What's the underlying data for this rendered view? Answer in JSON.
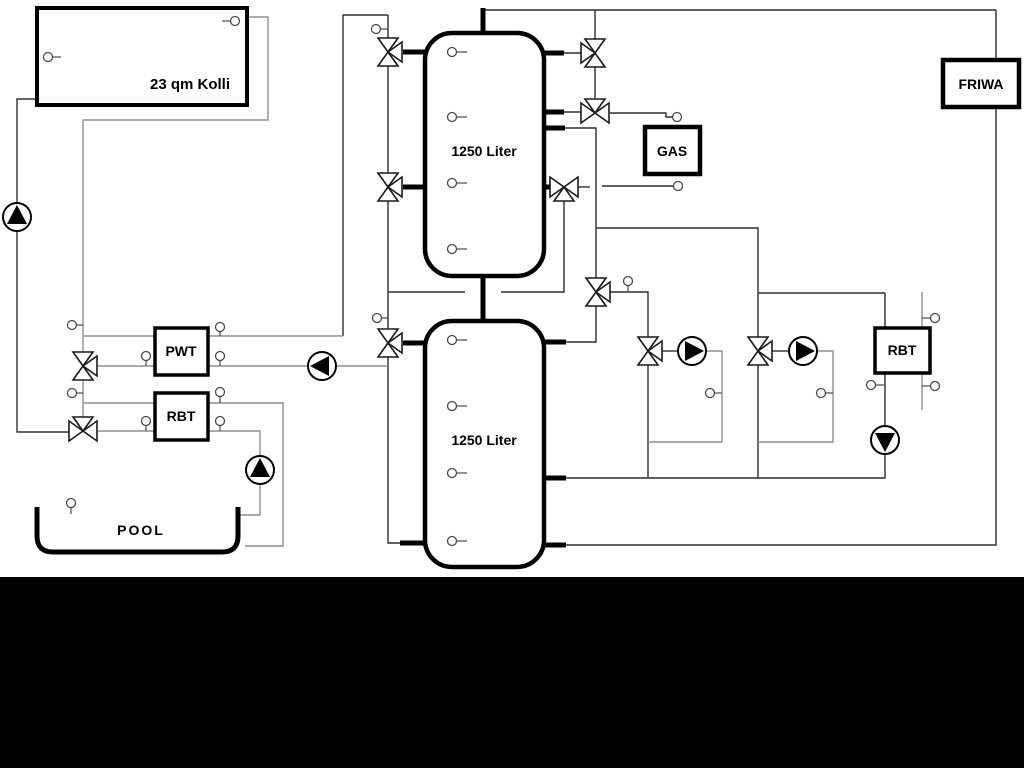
{
  "diagram": {
    "collector": {
      "label": "23 qm Kolli"
    },
    "buffer_tank_top": {
      "label": "1250 Liter"
    },
    "buffer_tank_bottom": {
      "label": "1250 Liter"
    },
    "gas_boiler": {
      "label": "GAS"
    },
    "friwa_station": {
      "label": "FRIWA"
    },
    "pwt_heat_exchanger": {
      "label": "PWT"
    },
    "rbt_left_module": {
      "label": "RBT"
    },
    "rbt_right_module": {
      "label": "RBT"
    },
    "pool": {
      "label": "POOL"
    },
    "colors": {
      "background": "#ffffff",
      "line_dark": "#2f2f2f",
      "line_gray": "#8f8f8f",
      "component_stroke": "#000000",
      "footer_bar": "#000000"
    }
  }
}
